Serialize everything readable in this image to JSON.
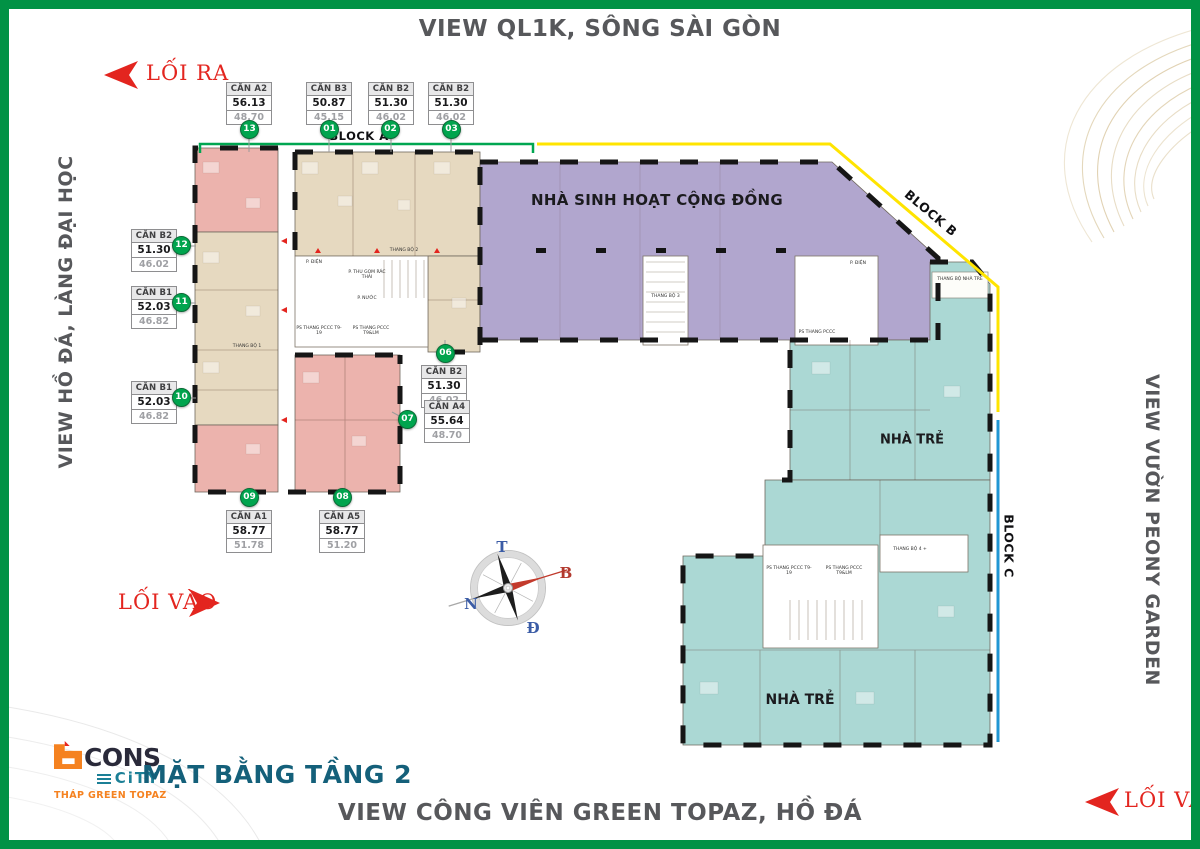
{
  "views": {
    "top": "VIEW QL1K, SÔNG SÀI GÒN",
    "bottom": "VIEW CÔNG VIÊN GREEN TOPAZ, HỒ ĐÁ",
    "left": "VIEW HỒ ĐÁ, LÀNG ĐẠI HỌC",
    "right": "VIEW VƯỜN PEONY GARDEN"
  },
  "circulation": {
    "exit_top_left": "LỐI RA",
    "entrance_left": "LỐI VÀO",
    "entrance_bottom_right": "LỐI VÀO"
  },
  "plan": {
    "floor_title": "MẶT BẰNG TẦNG 2",
    "blocks": [
      {
        "label": "BLOCK A",
        "color": "#00a651"
      },
      {
        "label": "BLOCK B",
        "color": "#ffe400"
      },
      {
        "label": "BLOCK C",
        "color": "#2196d3"
      }
    ],
    "zones": {
      "community": "NHÀ SINH HOẠT CỘNG ĐỒNG",
      "kindergarten_upper": "NHÀ TRẺ",
      "kindergarten_lower": "NHÀ TRẺ"
    },
    "zone_colors": {
      "community": "#b1a6ce",
      "kindergarten": "#abd8d4",
      "apartment_pink": "#ecb3ad",
      "apartment_beige": "#e6d9c0"
    },
    "units": [
      {
        "no": "13",
        "name": "CĂN A2",
        "area_total": "56.13",
        "area_net": "48.70"
      },
      {
        "no": "01",
        "name": "CĂN B3",
        "area_total": "50.87",
        "area_net": "45.15"
      },
      {
        "no": "02",
        "name": "CĂN B2",
        "area_total": "51.30",
        "area_net": "46.02"
      },
      {
        "no": "03",
        "name": "CĂN B2",
        "area_total": "51.30",
        "area_net": "46.02"
      },
      {
        "no": "12",
        "name": "CĂN B2",
        "area_total": "51.30",
        "area_net": "46.02"
      },
      {
        "no": "11",
        "name": "CĂN B1",
        "area_total": "52.03",
        "area_net": "46.82"
      },
      {
        "no": "10",
        "name": "CĂN B1",
        "area_total": "52.03",
        "area_net": "46.82"
      },
      {
        "no": "06",
        "name": "CĂN B2",
        "area_total": "51.30",
        "area_net": "46.02"
      },
      {
        "no": "07",
        "name": "CĂN A4",
        "area_total": "55.64",
        "area_net": "48.70"
      },
      {
        "no": "09",
        "name": "CĂN A1",
        "area_total": "58.77",
        "area_net": "51.78"
      },
      {
        "no": "08",
        "name": "CĂN A5",
        "area_total": "58.77",
        "area_net": "51.20"
      }
    ],
    "core_rooms": [
      "P. ĐIỆN",
      "THANG BỘ 2",
      "P. THU GOM RÁC THẢI",
      "P. NƯỚC",
      "PS THANG PCCC T9-19",
      "PS THANG PCCC T9&LM",
      "THANG BỘ 1",
      "THANG BỘ 3",
      "P. ĐIỆN",
      "PS THANG PCCC",
      "THANG BỘ NHÀ TRẺ",
      "PS THANG PCCC T9-19",
      "PS THANG PCCC T9&LM",
      "THANG BỘ 4 +"
    ]
  },
  "compass": {
    "t": "T",
    "b": "B",
    "n": "N",
    "d": "Đ"
  },
  "logo": {
    "cons": "CONS",
    "city": "CiTY",
    "tagline": "THÁP GREEN TOPAZ"
  }
}
